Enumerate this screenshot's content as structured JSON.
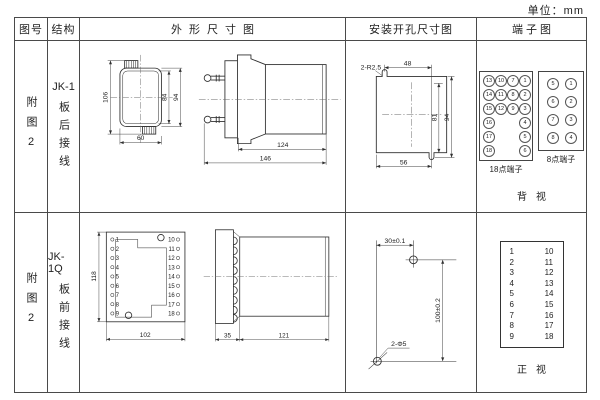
{
  "page": {
    "unit_label": "单位：mm",
    "line_color": "#4a4a4a"
  },
  "header": {
    "fig_no": "图号",
    "structure": "结构",
    "outline": "外形尺寸图",
    "install": "安装开孔尺寸图",
    "terminal": "端子图"
  },
  "rows": [
    {
      "fig_no": "附图2",
      "model": "JK-1",
      "wiring": "板后接线",
      "outline": {
        "front": {
          "height": "106",
          "inner_height": "84",
          "flange_height": "94",
          "width": "60"
        },
        "side": {
          "body_depth": "124",
          "total_depth": "146"
        }
      },
      "install": {
        "slot_label": "2-R2.5",
        "top_width": "48",
        "slot_span": "81",
        "height": "94",
        "bottom_width": "56"
      },
      "terminal": {
        "t18": {
          "label": "18点端子",
          "grid": [
            [
              "13",
              "10",
              "7",
              "1"
            ],
            [
              "14",
              "11",
              "8",
              "2"
            ],
            [
              "15",
              "12",
              "9",
              "3"
            ],
            [
              "16",
              "",
              "",
              "4"
            ],
            [
              "17",
              "",
              "",
              "5"
            ],
            [
              "18",
              "",
              "",
              "6"
            ]
          ]
        },
        "t8": {
          "label": "8点端子",
          "grid": [
            [
              "5",
              "1"
            ],
            [
              "6",
              "2"
            ],
            [
              "7",
              "3"
            ],
            [
              "8",
              "4"
            ]
          ]
        },
        "view_label": "背视"
      }
    },
    {
      "fig_no": "附图2",
      "model": "JK-1Q",
      "wiring": "板前接线",
      "outline": {
        "front": {
          "height": "118",
          "width": "102"
        },
        "side": {
          "plate_depth": "35",
          "body_depth": "121"
        }
      },
      "install": {
        "h_spacing": "30±0.1",
        "v_spacing": "100±0.2",
        "holes_label": "2-Φ5"
      },
      "terminal": {
        "left": [
          "1",
          "2",
          "3",
          "4",
          "5",
          "6",
          "7",
          "8",
          "9"
        ],
        "right": [
          "10",
          "11",
          "12",
          "13",
          "14",
          "15",
          "16",
          "17",
          "18"
        ],
        "view_label": "正视"
      }
    }
  ]
}
